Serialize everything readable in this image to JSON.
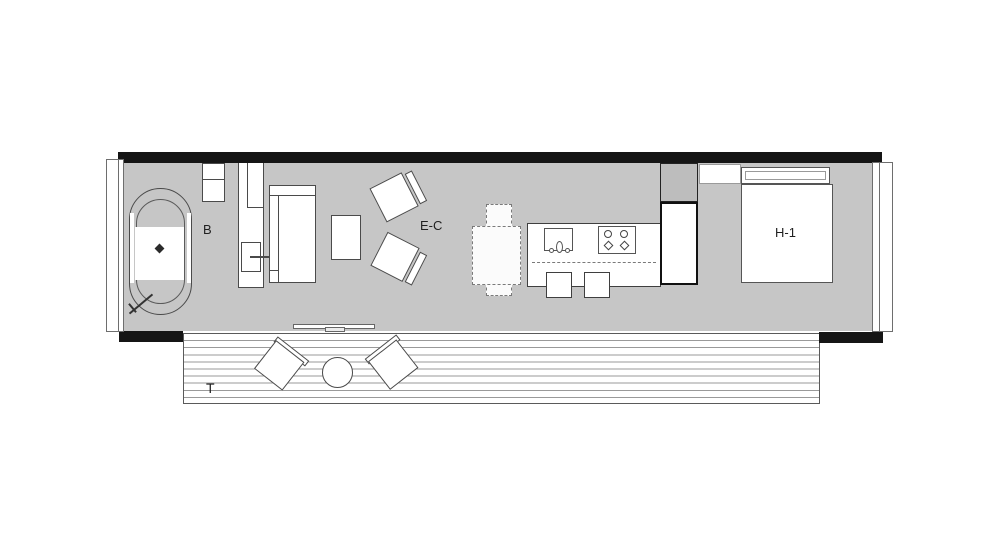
{
  "floor_plan": {
    "room_labels": {
      "bathroom": "B",
      "living_dining": "E-C",
      "bedroom": "H-1",
      "terrace": "T"
    },
    "colors": {
      "floor": "#c6c6c6",
      "wall": "#151515",
      "furniture_outline": "#4a4a4a",
      "closet_fill": "#bdbdbd",
      "deck_line": "#9a9a9a",
      "background": "#ffffff"
    }
  }
}
